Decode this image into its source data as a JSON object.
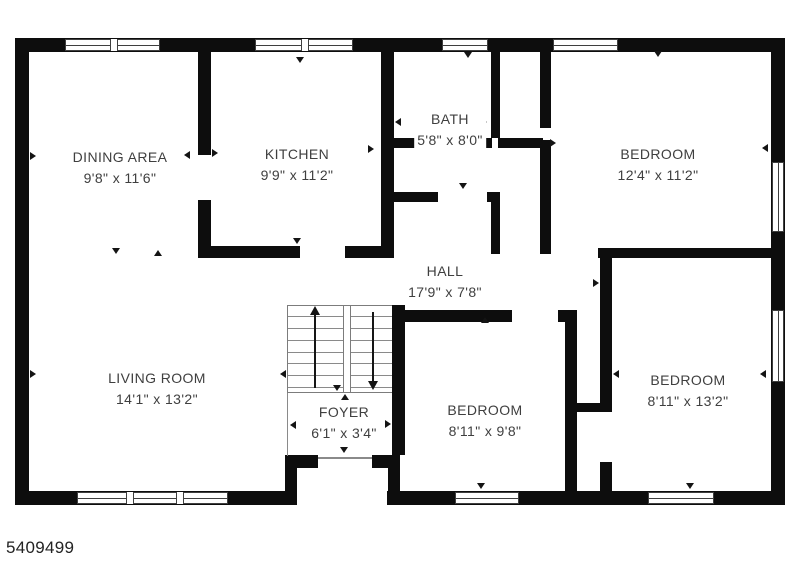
{
  "page": {
    "reference_number": "5409499",
    "background": "#ffffff"
  },
  "colors": {
    "wall": "#0d0d0d",
    "room_text": "#3f3f3f",
    "window_frame": "#3f3f3f"
  },
  "floor_plan": {
    "rooms": [
      {
        "name": "DINING AREA",
        "dimensions": "9'8\" x 11'6\"",
        "label_x": 120,
        "label_y": 158
      },
      {
        "name": "KITCHEN",
        "dimensions": "9'9\" x 11'2\"",
        "label_x": 297,
        "label_y": 155
      },
      {
        "name": "BATH",
        "dimensions": "5'8\" x 8'0\"",
        "label_x": 450,
        "label_y": 120
      },
      {
        "name": "BEDROOM",
        "dimensions": "12'4\" x 11'2\"",
        "label_x": 658,
        "label_y": 155
      },
      {
        "name": "HALL",
        "dimensions": "17'9\" x 7'8\"",
        "label_x": 445,
        "label_y": 272
      },
      {
        "name": "LIVING ROOM",
        "dimensions": "14'1\" x 13'2\"",
        "label_x": 157,
        "label_y": 379
      },
      {
        "name": "FOYER",
        "dimensions": "6'1\" x 3'4\"",
        "label_x": 344,
        "label_y": 413
      },
      {
        "name": "BEDROOM",
        "dimensions": "8'11\" x 9'8\"",
        "label_x": 485,
        "label_y": 411
      },
      {
        "name": "BEDROOM",
        "dimensions": "8'11\" x 13'2\"",
        "label_x": 688,
        "label_y": 381
      }
    ]
  }
}
